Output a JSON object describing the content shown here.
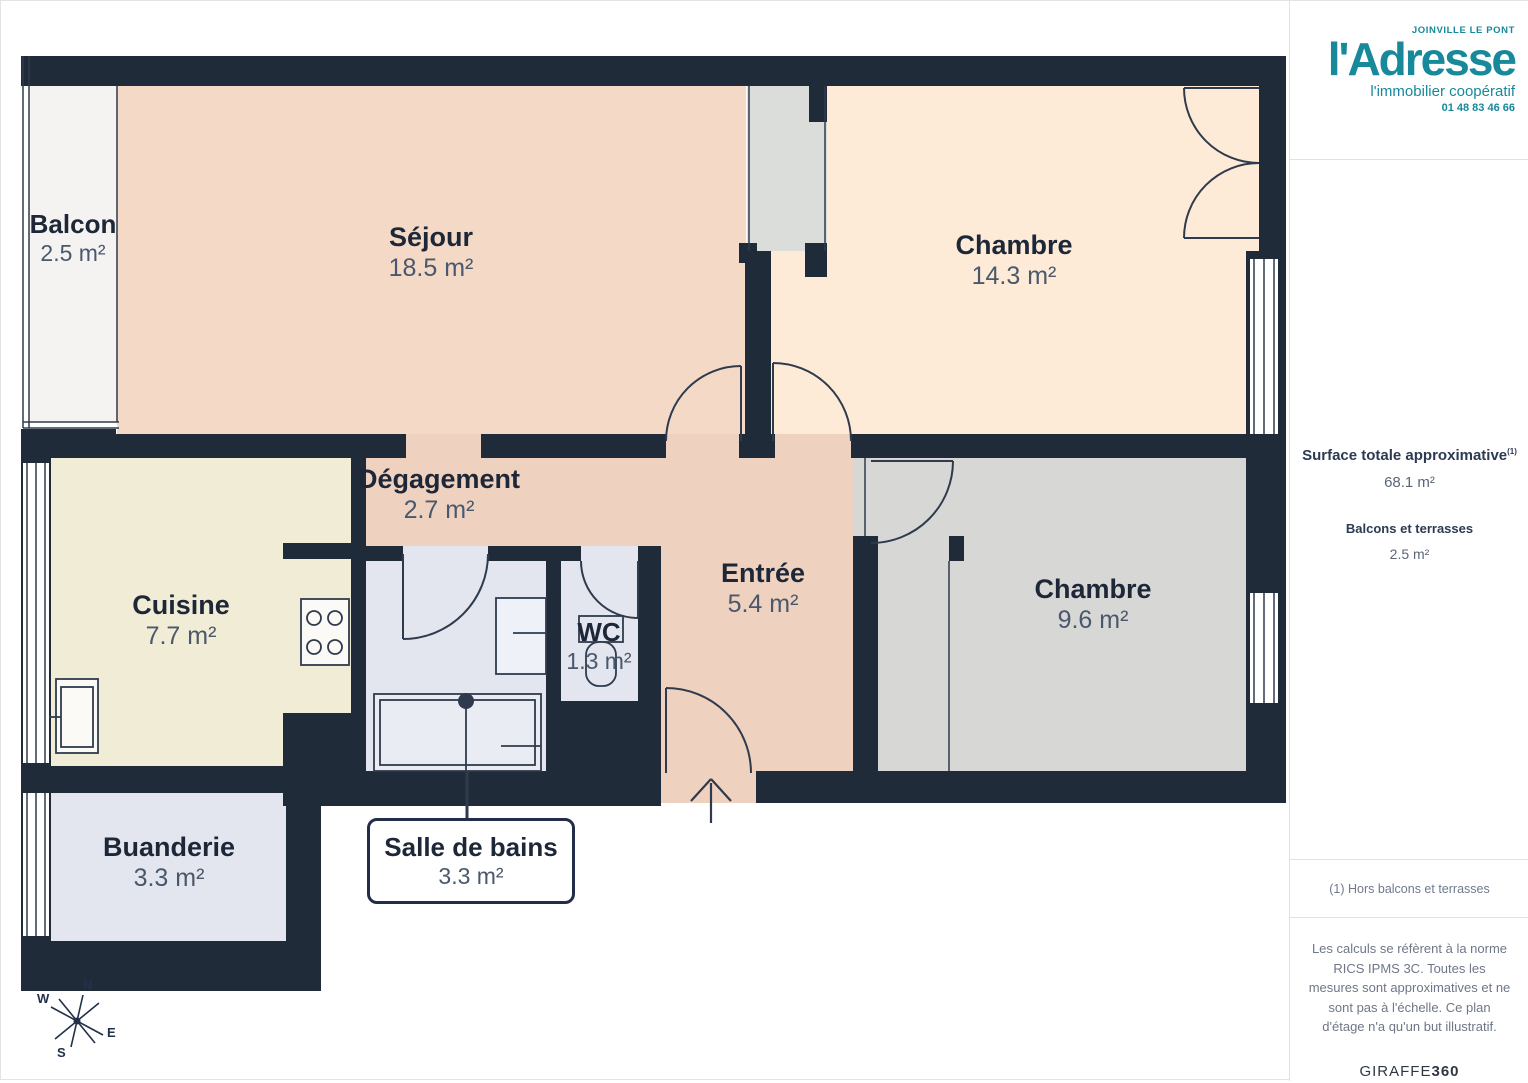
{
  "branding": {
    "location": "JOINVILLE LE PONT",
    "name": "l'Adresse",
    "tagline": "l'immobilier coopératif",
    "phone": "01 48 83 46 66"
  },
  "summary": {
    "title": "Surface totale approximative",
    "footnote_marker": "(1)",
    "total_value": "68.1 m²",
    "balconies_label": "Balcons et terrasses",
    "balconies_value": "2.5 m²"
  },
  "footnote": "(1) Hors balcons et terrasses",
  "disclaimer": "Les calculs se réfèrent à la norme RICS IPMS 3C. Toutes les mesures sont approximatives et ne sont pas à l'échelle. Ce plan d'étage n'a qu'un but illustratif.",
  "provider": {
    "name": "GIRAFFE",
    "suffix": "360"
  },
  "compass": {
    "n": "N",
    "e": "E",
    "s": "S",
    "w": "W"
  },
  "rooms": [
    {
      "name": "Balcon",
      "area": "2.5 m²"
    },
    {
      "name": "Séjour",
      "area": "18.5 m²"
    },
    {
      "name": "Chambre",
      "area": "14.3 m²"
    },
    {
      "name": "Dégagement",
      "area": "2.7 m²"
    },
    {
      "name": "Cuisine",
      "area": "7.7 m²"
    },
    {
      "name": "Entrée",
      "area": "5.4 m²"
    },
    {
      "name": "WC",
      "area": "1.3 m²"
    },
    {
      "name": "Chambre",
      "area": "9.6 m²"
    },
    {
      "name": "Buanderie",
      "area": "3.3 m²"
    },
    {
      "name": "Salle de bains",
      "area": "3.3 m²"
    }
  ],
  "colors": {
    "accent_teal": "#17899a",
    "wall": "#202b3a",
    "sejour": "#f3d9c6",
    "chambre_1": "#fdebd8",
    "entree_degagement": "#efd1bf",
    "cuisine": "#f1ecd6",
    "bathroom_wc_buanderie": "#e3e6ef",
    "chambre_2": "#d7d7d6",
    "balcon": "#f4f3f2",
    "shaft": "#dbdddb"
  }
}
